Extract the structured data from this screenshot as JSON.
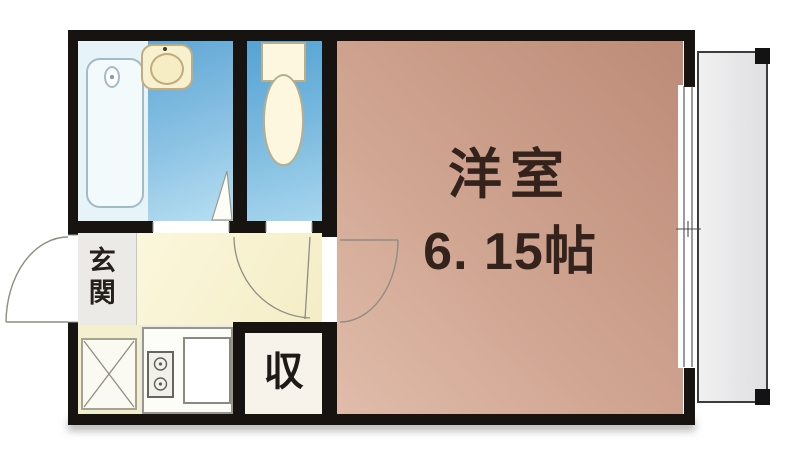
{
  "plan": {
    "type": "apartment-floor-plan",
    "rooms": {
      "main_room": {
        "label": "洋室",
        "size": "6. 15帖"
      },
      "entrance": {
        "label": "玄関"
      },
      "closet": {
        "label": "収"
      },
      "bathroom": {
        "fixtures": [
          "bathtub-icon",
          "sink-icon",
          "door-swing"
        ]
      },
      "toilet": {
        "fixtures": [
          "toilet-icon",
          "door-swing"
        ]
      },
      "kitchen": {
        "fixtures": [
          "stove-icon",
          "counter-icon",
          "washing-machine-pan-icon"
        ]
      },
      "balcony": {
        "fixtures": []
      }
    },
    "colors": {
      "wall": "#171310",
      "main_room_floor": "#c89583",
      "wet_area_floor": "#6fb0da",
      "hallway_floor": "#f7f2d2",
      "entrance_floor": "#eceae6",
      "closet_floor": "#f8f3ea",
      "balcony_floor": "#e9e9eb",
      "label_text": "#33231c"
    }
  }
}
